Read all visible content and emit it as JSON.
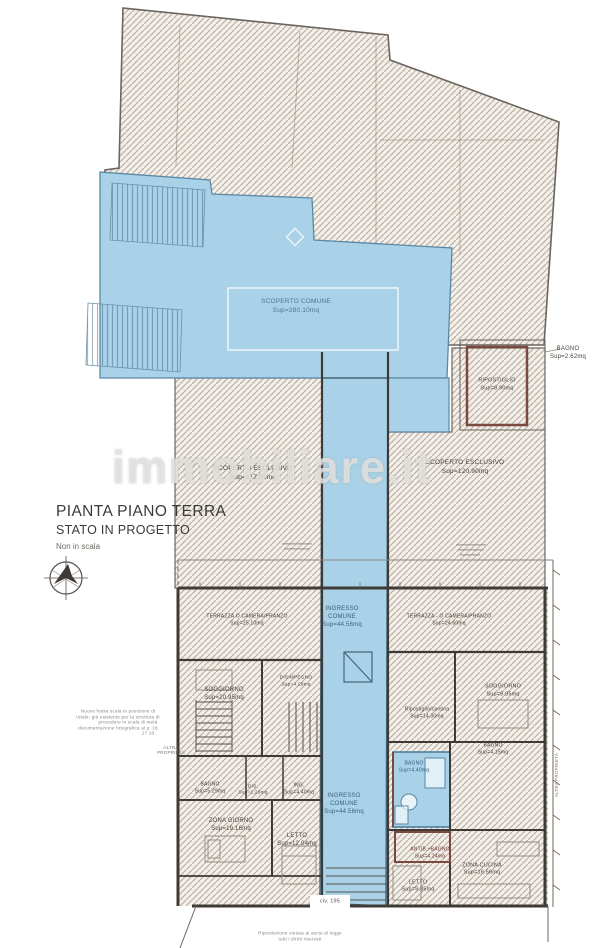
{
  "title": {
    "line1": "PIANTA PIANO TERRA",
    "line2": "STATO IN PROGETTO",
    "line3": "Non in scala"
  },
  "watermark": {
    "text": "immobiliare.it"
  },
  "colors": {
    "highlight_blue": "#a9d2e8",
    "blue_border": "#5b87a3",
    "hatch_line": "#b6a798",
    "wall": "#3e3a36",
    "accent_red": "#7a4a40"
  },
  "labels": [
    {
      "name": "label-scoperto-comune-1",
      "text": "SCOPERTO COMUNE",
      "x": 296,
      "y": 302,
      "size": 6.5,
      "color": "#4d748e"
    },
    {
      "name": "label-scoperto-comune-2",
      "text": "Sup=280.10mq",
      "x": 296,
      "y": 311,
      "size": 6.5,
      "color": "#4d748e"
    },
    {
      "name": "label-scoperto-esclusivo-left-1",
      "text": "SCOPERTO ESCLUSIVO",
      "x": 253,
      "y": 469,
      "size": 6.5
    },
    {
      "name": "label-scoperto-esclusivo-left-2",
      "text": "Sup=117.31mq",
      "x": 253,
      "y": 478,
      "size": 6.5
    },
    {
      "name": "label-scoperto-esclusivo-right-1",
      "text": "SCOPERTO ESCLUSIVO",
      "x": 465,
      "y": 463,
      "size": 6.5
    },
    {
      "name": "label-scoperto-esclusivo-right-2",
      "text": "Sup=120.90mq",
      "x": 465,
      "y": 472,
      "size": 6.5
    },
    {
      "name": "label-bagno-topright-1",
      "text": "BAGNO",
      "x": 568,
      "y": 349,
      "size": 6
    },
    {
      "name": "label-bagno-topright-2",
      "text": "Sup=2.62mq",
      "x": 568,
      "y": 357,
      "size": 6
    },
    {
      "name": "label-ripostiglio-1",
      "text": "RIPOSTIGLIO",
      "x": 497,
      "y": 381,
      "size": 5.5
    },
    {
      "name": "label-ripostiglio-2",
      "text": "Sup=8.90mq",
      "x": 497,
      "y": 389,
      "size": 5.5
    },
    {
      "name": "label-ingresso-comune-1a",
      "text": "INGRESSO",
      "x": 342,
      "y": 609,
      "size": 6,
      "color": "#3c6078"
    },
    {
      "name": "label-ingresso-comune-1b",
      "text": "COMUNE",
      "x": 342,
      "y": 617,
      "size": 6,
      "color": "#3c6078"
    },
    {
      "name": "label-ingresso-comune-1c",
      "text": "Sup=44.56mq",
      "x": 342,
      "y": 625,
      "size": 6,
      "color": "#3c6078"
    },
    {
      "name": "label-terrazza-left-1",
      "text": "TERRAZZA O CAMERA/PRANZO",
      "x": 247,
      "y": 617,
      "size": 5
    },
    {
      "name": "label-terrazza-left-2",
      "text": "Sup=25.10mq",
      "x": 247,
      "y": 624,
      "size": 5
    },
    {
      "name": "label-terrazza-right-1",
      "text": "TERRAZZA - O CAMERA/PRANZO",
      "x": 449,
      "y": 617,
      "size": 5
    },
    {
      "name": "label-terrazza-right-2",
      "text": "Sup=24.60mq",
      "x": 449,
      "y": 624,
      "size": 5
    },
    {
      "name": "label-soggiorno-left-1",
      "text": "SOGGIORNO",
      "x": 224,
      "y": 690,
      "size": 6
    },
    {
      "name": "label-soggiorno-left-2",
      "text": "Sup=20.95mq",
      "x": 224,
      "y": 698,
      "size": 6
    },
    {
      "name": "label-disimpegno-1",
      "text": "DISIMPEGNO",
      "x": 296,
      "y": 679,
      "size": 4.8
    },
    {
      "name": "label-disimpegno-2",
      "text": "Sup=4.28mq",
      "x": 296,
      "y": 686,
      "size": 4.8
    },
    {
      "name": "label-soggiorno-right-1",
      "text": "SOGGIORNO",
      "x": 503,
      "y": 687,
      "size": 5.5
    },
    {
      "name": "label-soggiorno-right-2",
      "text": "Sup=9.05mq",
      "x": 503,
      "y": 695,
      "size": 5.5
    },
    {
      "name": "label-ripostiglio-cantina-1",
      "text": "Ripostiglio/cantina",
      "x": 427,
      "y": 710,
      "size": 5
    },
    {
      "name": "label-ripostiglio-cantina-2",
      "text": "Sup=14.30mq",
      "x": 427,
      "y": 717,
      "size": 5
    },
    {
      "name": "label-bagno-right-1",
      "text": "BAGNO",
      "x": 493,
      "y": 746,
      "size": 5
    },
    {
      "name": "label-bagno-right-2",
      "text": "Sup=4.15mq",
      "x": 493,
      "y": 753,
      "size": 5
    },
    {
      "name": "label-bagno-blue-1",
      "text": "BAGNO",
      "x": 414,
      "y": 764,
      "size": 5,
      "color": "#2f5d7c"
    },
    {
      "name": "label-bagno-blue-2",
      "text": "Sup=4.40mq",
      "x": 414,
      "y": 771,
      "size": 5,
      "color": "#2f5d7c"
    },
    {
      "name": "label-bagno-bottomleft-1",
      "text": "BAGNO",
      "x": 210,
      "y": 785,
      "size": 5
    },
    {
      "name": "label-bagno-bottomleft-2",
      "text": "Sup=5.29mq",
      "x": 210,
      "y": 792,
      "size": 5
    },
    {
      "name": "label-dis-1",
      "text": "DIS.",
      "x": 253,
      "y": 788,
      "size": 4.8
    },
    {
      "name": "label-dis-2",
      "text": "Sup=1.29mq",
      "x": 253,
      "y": 794,
      "size": 4.8
    },
    {
      "name": "label-ing-1",
      "text": "ING.",
      "x": 299,
      "y": 786,
      "size": 5
    },
    {
      "name": "label-ing-2",
      "text": "Sup=4.40mq",
      "x": 299,
      "y": 793,
      "size": 5
    },
    {
      "name": "label-zona-giorno-1",
      "text": "ZONA GIORNO",
      "x": 231,
      "y": 821,
      "size": 6
    },
    {
      "name": "label-zona-giorno-2",
      "text": "Sup=19.16mq",
      "x": 231,
      "y": 829,
      "size": 6
    },
    {
      "name": "label-letto-left-1",
      "text": "LETTO",
      "x": 297,
      "y": 836,
      "size": 6
    },
    {
      "name": "label-letto-left-2",
      "text": "Sup=12.04mq",
      "x": 297,
      "y": 844,
      "size": 6
    },
    {
      "name": "label-ingresso-comune-2a",
      "text": "INGRESSO",
      "x": 344,
      "y": 796,
      "size": 6,
      "color": "#3c6078"
    },
    {
      "name": "label-ingresso-comune-2b",
      "text": "COMUNE",
      "x": 344,
      "y": 804,
      "size": 6,
      "color": "#3c6078"
    },
    {
      "name": "label-ingresso-comune-2c",
      "text": "Sup=44.56mq",
      "x": 344,
      "y": 812,
      "size": 6,
      "color": "#3c6078"
    },
    {
      "name": "label-antibagno-1",
      "text": "ANTIB.+BAGNO",
      "x": 430,
      "y": 850,
      "size": 5,
      "color": "#6e3a32"
    },
    {
      "name": "label-antibagno-2",
      "text": "Sup=4.24mq",
      "x": 430,
      "y": 857,
      "size": 5,
      "color": "#6e3a32"
    },
    {
      "name": "label-letto-right-1",
      "text": "LETTO",
      "x": 418,
      "y": 883,
      "size": 5.5
    },
    {
      "name": "label-letto-right-2",
      "text": "Sup=9.85mq",
      "x": 418,
      "y": 890,
      "size": 5.5
    },
    {
      "name": "label-zona-cucina-1",
      "text": "ZONA CUCINA",
      "x": 482,
      "y": 866,
      "size": 5.5
    },
    {
      "name": "label-zona-cucina-2",
      "text": "Sup=16.56mq",
      "x": 482,
      "y": 873,
      "size": 5.5
    },
    {
      "name": "label-civico",
      "text": "civ. 195",
      "x": 330,
      "y": 902,
      "size": 5.5,
      "color": "#55514c"
    },
    {
      "name": "label-altra-proprieta-1",
      "text": "ALTRA",
      "x": 171,
      "y": 748,
      "size": 4.5,
      "color": "#7a756f"
    },
    {
      "name": "label-altra-proprieta-2",
      "text": "PROPRIETÀ",
      "x": 171,
      "y": 753,
      "size": 4.5,
      "color": "#7a756f"
    },
    {
      "name": "label-altra-proprieta-right",
      "text": "ALTRA PROPRIETÀ",
      "x": 557,
      "y": 775,
      "size": 4.5,
      "color": "#7a756f",
      "rot": -90
    },
    {
      "name": "note-line-1",
      "text": "Nuova fossa scala in posizione di",
      "x": 118,
      "y": 712,
      "size": 4.6,
      "color": "#8a857f"
    },
    {
      "name": "note-line-2",
      "text": "totale; già esistente per la struttura di",
      "x": 118,
      "y": 718,
      "size": 4.6,
      "color": "#8a857f"
    },
    {
      "name": "note-line-3",
      "text": "procedere in scala di metà",
      "x": 128,
      "y": 723,
      "size": 4.6,
      "color": "#8a857f"
    },
    {
      "name": "note-line-4",
      "text": "documentazione fotografica al p. 16",
      "x": 118,
      "y": 729,
      "size": 4.6,
      "color": "#8a857f"
    },
    {
      "name": "note-line-5",
      "text": "17 18",
      "x": 148,
      "y": 734,
      "size": 4.6,
      "color": "#8a857f"
    },
    {
      "name": "bottom-note-1",
      "text": "Riproduzione vietata ai sensi di legge",
      "x": 300,
      "y": 934,
      "size": 4.6,
      "color": "#8a857f"
    },
    {
      "name": "bottom-note-2",
      "text": "tutti i diritti riservati",
      "x": 300,
      "y": 940,
      "size": 4.6,
      "color": "#8a857f"
    }
  ]
}
